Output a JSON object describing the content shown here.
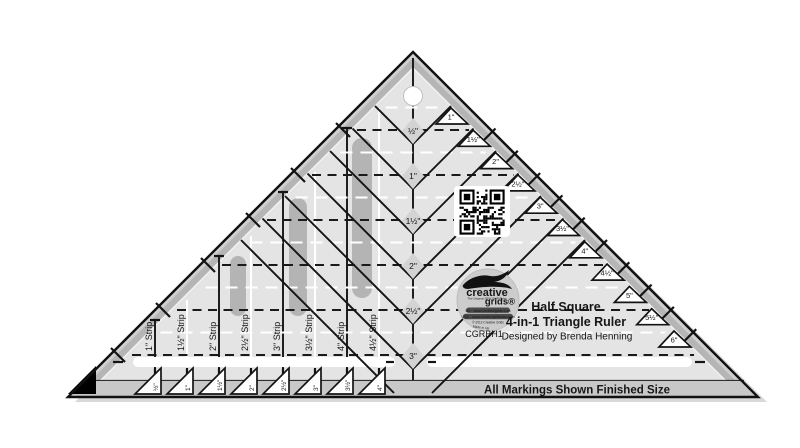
{
  "product": {
    "brand": "creative grids",
    "brand_word1": "creative",
    "brand_word2": "grids®",
    "brand_tagline": "The Original SEW SLIP Ruler",
    "brand_url_uk": "UK - www.creativegrids.com",
    "brand_url_usa": "USA - www.creativegridsusa.com",
    "brand_copyright": "© 2012 Creative Grids",
    "brand_origin": "Made in UK",
    "model": "CGRBH1",
    "title_line1": "Half Square",
    "title_line2": "4-in-1 Triangle Ruler",
    "designer": "Designed by Brenda Henning",
    "footer_note": "All Markings Shown Finished Size"
  },
  "markings": {
    "center_sizes": [
      "½\"",
      "1\"",
      "1½\"",
      "2\"",
      "2½\"",
      "3\""
    ],
    "edge_sizes": [
      "1\"",
      "1½\"",
      "2\"",
      "2½\"",
      "3\"",
      "3½\"",
      "4\"",
      "4½\"",
      "5\"",
      "5½\"",
      "6\""
    ],
    "strip_labels": [
      "1\" Strip",
      "1½\" Strip",
      "2\" Strip",
      "2½\" Strip",
      "3\" Strip",
      "3½\" Strip",
      "4\" Strip",
      "4½\" Strip"
    ],
    "bottom_sizes": [
      "½\"",
      "1\"",
      "1½\"",
      "2\"",
      "2½\"",
      "3\"",
      "3½\"",
      "4\""
    ]
  },
  "colors": {
    "ruler_body": "#e4e4e4",
    "edge_band": "#b5b5b5",
    "edge_band_outer": "#cfcfcf",
    "slot_gray": "#b4b4b4",
    "bottom_band": "#c8c8c8",
    "marking_black": "#161616",
    "marking_white": "#ffffff"
  }
}
